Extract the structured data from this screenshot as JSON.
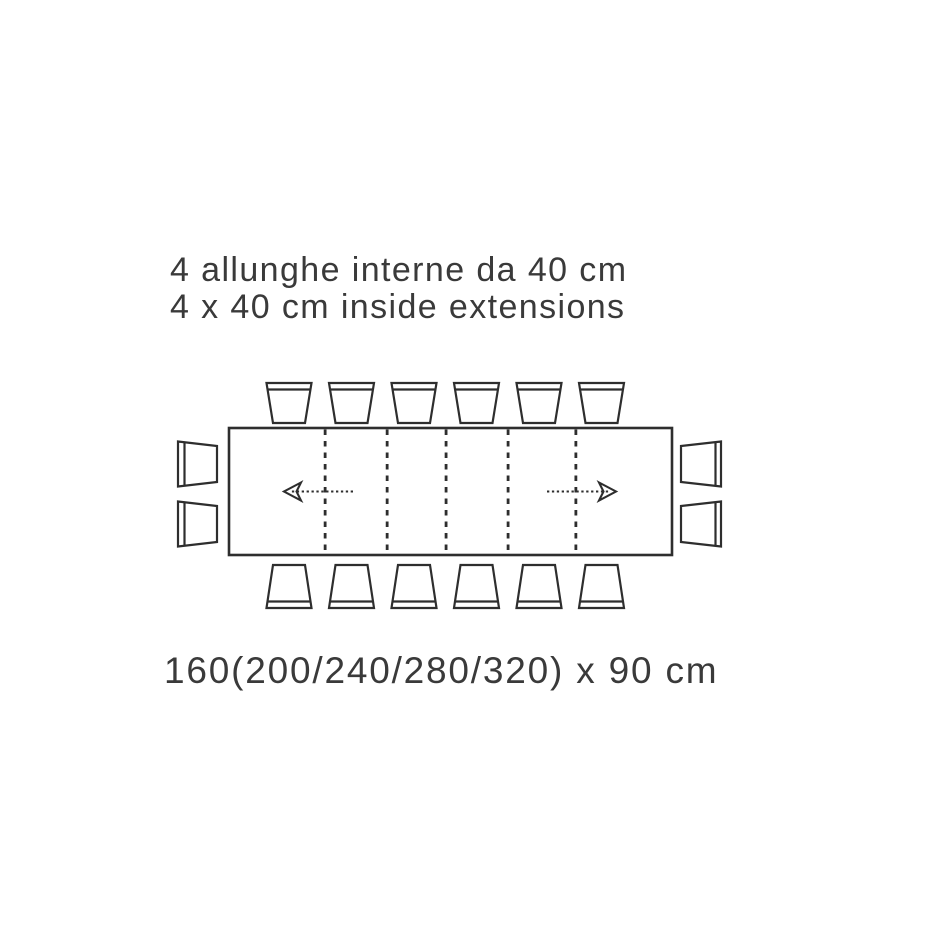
{
  "title": {
    "line_it": "4 allunghe interne da 40 cm",
    "line_en": "4 x 40 cm inside extensions"
  },
  "dimension_label": "160(200/240/280/320) x 90 cm",
  "colors": {
    "background": "#ffffff",
    "ink": "#3a3a3a",
    "line": "#2e2e2e",
    "fill": "#ffffff"
  },
  "diagram": {
    "kind": "extendable-table-top-view",
    "seats": {
      "top": 6,
      "bottom": 6,
      "left": 2,
      "right": 2
    },
    "extension_dividers": 5,
    "divider_positions_frac": [
      0.217,
      0.357,
      0.49,
      0.63,
      0.783
    ],
    "arrows": [
      {
        "direction": "left"
      },
      {
        "direction": "right"
      }
    ]
  }
}
